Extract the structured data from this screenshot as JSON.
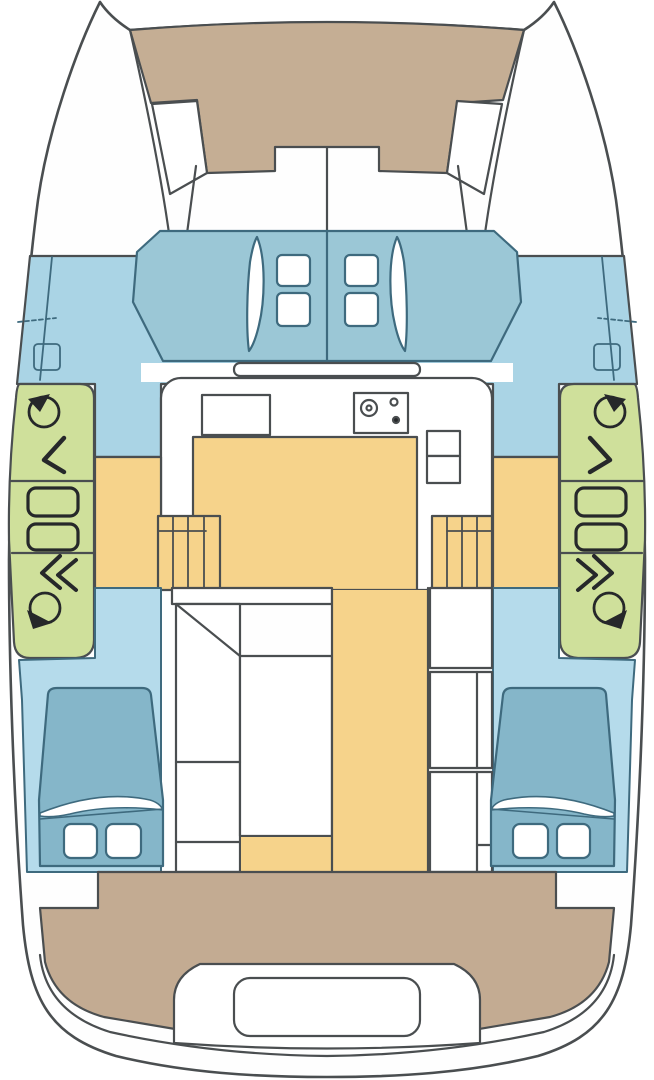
{
  "plan": {
    "type": "catamaran-deck-and-accommodation-plan",
    "orientation": "bow-up",
    "components": {
      "hulls": 2,
      "bow_trampoline": 1,
      "trampoline_side_hatches": 2,
      "coachroof_hatches": 4,
      "coachroof_vent_slits": 2,
      "deck_winches": 4,
      "deck_cleats": 4,
      "deck_line_arrows": 6,
      "galley": {
        "stove_burners": 3,
        "sink": 1,
        "fridge_compartments": 2
      },
      "hull_stairways": 2,
      "aft_cabin_beds": 2,
      "pillows_per_bed": 2,
      "cockpit_table": 1,
      "transom_steps": 1
    }
  },
  "colors": {
    "page_white": "#ffffff",
    "hull_white": "#fefefe",
    "outline": "#4a4e50",
    "blue_line": "#3e6a7e",
    "black": "#26282a",
    "trampoline_tan": "#c5ae94",
    "cockpit_tan": "#c3ab92",
    "foredeck_blue": "#aad4e5",
    "cabin_floor_blue": "#b5dbeb",
    "coach_roof_blue": "#9bc7d6",
    "bed_blue": "#85b6c9",
    "sole_yellow": "#f6d38b",
    "panel_green": "#cfe09b",
    "white_fill": "#ffffff"
  }
}
